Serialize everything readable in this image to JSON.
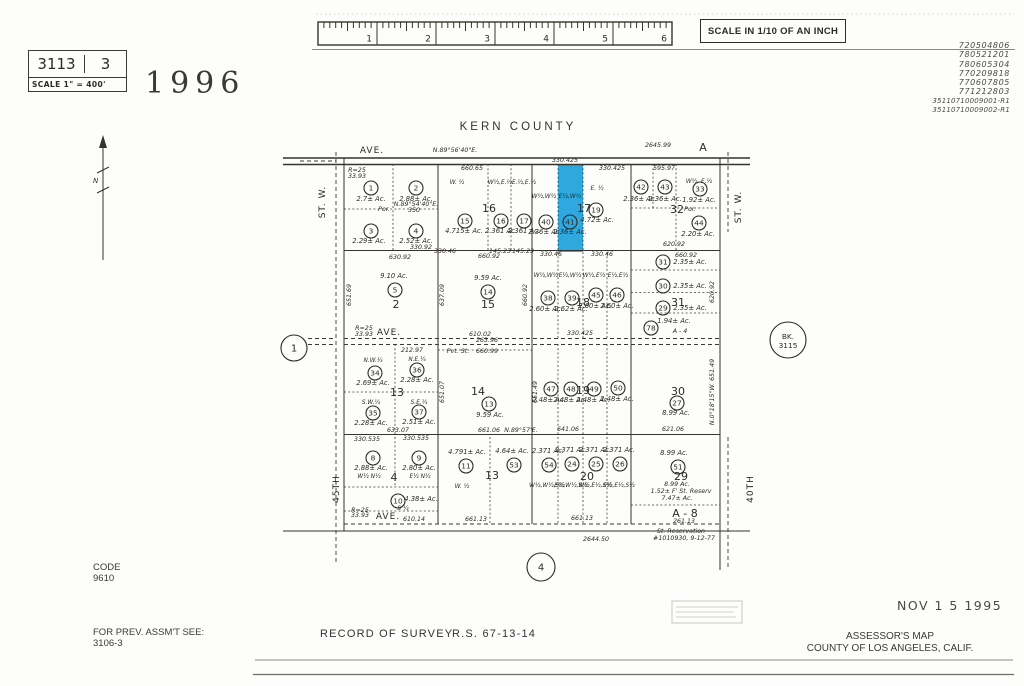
{
  "header": {
    "book": "3113",
    "page": "3",
    "scale_note": "SCALE 1\" = 400'",
    "year": "1996",
    "ruler_caption": "SCALE IN 1/10 OF AN INCH",
    "ruler_ticks": [
      "1",
      "2",
      "3",
      "4",
      "5",
      "6"
    ],
    "stamp_numbers": [
      "720504806",
      "780521201",
      "780605304",
      "770209818",
      "770607805",
      "771212803",
      "35110710009001-R1",
      "35110710009002-R1"
    ]
  },
  "map": {
    "county_label": "KERN  COUNTY",
    "highlight": {
      "parcel": "41",
      "x": 558,
      "y": 164,
      "w": 25,
      "h": 88,
      "color": "#2fa8df"
    },
    "north_label": "N",
    "ref_circles": [
      {
        "label": "1",
        "x": 294,
        "y": 348,
        "r": 13
      },
      {
        "label": "4",
        "x": 541,
        "y": 567,
        "r": 14
      },
      {
        "label": "BK.",
        "label2": "3115",
        "x": 788,
        "y": 340,
        "r": 18
      }
    ],
    "streets": [
      {
        "t": "ST. W.",
        "x": 325,
        "y": 202,
        "rot": -90
      },
      {
        "t": "ST. W.",
        "x": 741,
        "y": 207,
        "rot": -90
      },
      {
        "t": "45TH",
        "x": 339,
        "y": 489,
        "rot": -90
      },
      {
        "t": "40TH",
        "x": 753,
        "y": 489,
        "rot": -90
      },
      {
        "t": "AVE.",
        "x": 389,
        "y": 335,
        "rot": 0
      },
      {
        "t": "AVE.",
        "x": 388,
        "y": 519,
        "rot": 0
      },
      {
        "t": "AVE.",
        "x": 372,
        "y": 153,
        "rot": 0
      }
    ],
    "sections": [
      {
        "t": "16",
        "x": 489,
        "y": 212
      },
      {
        "t": "17",
        "x": 584,
        "y": 212
      },
      {
        "t": "32",
        "x": 677,
        "y": 213
      },
      {
        "t": "2",
        "x": 396,
        "y": 308
      },
      {
        "t": "15",
        "x": 488,
        "y": 308
      },
      {
        "t": "18",
        "x": 583,
        "y": 306
      },
      {
        "t": "31",
        "x": 678,
        "y": 306
      },
      {
        "t": "13",
        "x": 397,
        "y": 396
      },
      {
        "t": "14",
        "x": 478,
        "y": 395
      },
      {
        "t": "19",
        "x": 583,
        "y": 394
      },
      {
        "t": "30",
        "x": 678,
        "y": 395
      },
      {
        "t": "4",
        "x": 394,
        "y": 481
      },
      {
        "t": "13",
        "x": 492,
        "y": 479
      },
      {
        "t": "20",
        "x": 587,
        "y": 480
      },
      {
        "t": "29",
        "x": 681,
        "y": 480
      },
      {
        "t": "A - 8",
        "x": 685,
        "y": 517
      },
      {
        "t": "A",
        "x": 703,
        "y": 151
      }
    ],
    "parcels": [
      {
        "num": "1",
        "cx": 371,
        "cy": 188,
        "ac": "2.7± Ac.",
        "ax": 371,
        "ay": 201
      },
      {
        "num": "2",
        "cx": 416,
        "cy": 188,
        "ac": "2.88± Ac.",
        "ax": 416,
        "ay": 201
      },
      {
        "num": "3",
        "cx": 371,
        "cy": 231,
        "ac": "2.29± Ac.",
        "ax": 369,
        "ay": 243
      },
      {
        "num": "4",
        "cx": 416,
        "cy": 231,
        "ac": "2.52± Ac.",
        "ax": 416,
        "ay": 243
      },
      {
        "num": "15",
        "cx": 465,
        "cy": 221,
        "ac": "4.715± Ac.",
        "ax": 464,
        "ay": 233
      },
      {
        "num": "16",
        "cx": 501,
        "cy": 221,
        "ac": "2.361 Ac.",
        "ax": 501,
        "ay": 233
      },
      {
        "num": "17",
        "cx": 524,
        "cy": 221,
        "ac": "2.361 Ac.",
        "ax": 524,
        "ay": 233
      },
      {
        "num": "40",
        "cx": 546,
        "cy": 222,
        "ac": "2.36± Ac.",
        "ax": 545,
        "ay": 234
      },
      {
        "num": "41",
        "cx": 570,
        "cy": 222,
        "ac": "2.36± Ac.",
        "ax": 570,
        "ay": 234
      },
      {
        "num": "19",
        "cx": 596,
        "cy": 210,
        "ac": "4.72± Ac.",
        "ax": 597,
        "ay": 222
      },
      {
        "num": "42",
        "cx": 641,
        "cy": 187,
        "ac": "2.36± Ac.",
        "ax": 640,
        "ay": 201
      },
      {
        "num": "43",
        "cx": 665,
        "cy": 187,
        "ac": "2.36± Ac.",
        "ax": 665,
        "ay": 201
      },
      {
        "num": "33",
        "cx": 700,
        "cy": 189,
        "ac": "1.92± Ac.",
        "ax": 699,
        "ay": 202
      },
      {
        "num": "44",
        "cx": 699,
        "cy": 223,
        "ac": "2.20± Ac.",
        "ax": 698,
        "ay": 236
      },
      {
        "num": "5",
        "cx": 395,
        "cy": 290,
        "ac": "9.10 Ac.",
        "ax": 394,
        "ay": 278
      },
      {
        "num": "14",
        "cx": 488,
        "cy": 292,
        "ac": "9.59 Ac.",
        "ax": 488,
        "ay": 280
      },
      {
        "num": "38",
        "cx": 548,
        "cy": 298,
        "ac": "2.60± Ac.",
        "ax": 546,
        "ay": 311
      },
      {
        "num": "39",
        "cx": 572,
        "cy": 298,
        "ac": "2.62± Ac.",
        "ax": 571,
        "ay": 311
      },
      {
        "num": "45",
        "cx": 596,
        "cy": 295,
        "ac": "2.60± Ac.",
        "ax": 595,
        "ay": 308
      },
      {
        "num": "46",
        "cx": 617,
        "cy": 295,
        "ac": "2.60± Ac.",
        "ax": 617,
        "ay": 308
      },
      {
        "num": "31",
        "cx": 663,
        "cy": 262,
        "ac": "2.35± Ac.",
        "ax": 690,
        "ay": 264
      },
      {
        "num": "30",
        "cx": 663,
        "cy": 286,
        "ac": "2.35± Ac.",
        "ax": 690,
        "ay": 288
      },
      {
        "num": "29",
        "cx": 663,
        "cy": 308,
        "ac": "2.35± Ac.",
        "ax": 690,
        "ay": 310
      },
      {
        "num": "78",
        "cx": 651,
        "cy": 328,
        "ac": "1.94± Ac.",
        "ax": 674,
        "ay": 323
      },
      {
        "num": "34",
        "cx": 375,
        "cy": 373,
        "ac": "2.69± Ac.",
        "ax": 373,
        "ay": 385
      },
      {
        "num": "36",
        "cx": 417,
        "cy": 370,
        "ac": "2.28± Ac.",
        "ax": 417,
        "ay": 382
      },
      {
        "num": "35",
        "cx": 373,
        "cy": 413,
        "ac": "2.28± Ac.",
        "ax": 371,
        "ay": 425
      },
      {
        "num": "37",
        "cx": 419,
        "cy": 412,
        "ac": "2.51± Ac.",
        "ax": 419,
        "ay": 424
      },
      {
        "num": "13",
        "cx": 489,
        "cy": 404,
        "ac": "9.59 Ac.",
        "ax": 490,
        "ay": 417
      },
      {
        "num": "47",
        "cx": 551,
        "cy": 389,
        "ac": "2.48± Ac.",
        "ax": 549,
        "ay": 402
      },
      {
        "num": "48",
        "cx": 571,
        "cy": 389,
        "ac": "2.48± Ac.",
        "ax": 570,
        "ay": 402
      },
      {
        "num": "49",
        "cx": 594,
        "cy": 389,
        "ac": "2.48± Ac.",
        "ax": 593,
        "ay": 402
      },
      {
        "num": "50",
        "cx": 618,
        "cy": 388,
        "ac": "2.48± Ac.",
        "ax": 617,
        "ay": 401
      },
      {
        "num": "27",
        "cx": 677,
        "cy": 403,
        "ac": "8.99 Ac.",
        "ax": 676,
        "ay": 415
      },
      {
        "num": "8",
        "cx": 373,
        "cy": 458,
        "ac": "2.88± Ac.",
        "ax": 371,
        "ay": 470
      },
      {
        "num": "9",
        "cx": 419,
        "cy": 458,
        "ac": "2.80± Ac.",
        "ax": 419,
        "ay": 470
      },
      {
        "num": "10",
        "cx": 398,
        "cy": 501,
        "ac": "4.38± Ac.",
        "ax": 421,
        "ay": 501
      },
      {
        "num": "11",
        "cx": 466,
        "cy": 466,
        "ac": "4.791± Ac.",
        "ax": 467,
        "ay": 454
      },
      {
        "num": "53",
        "cx": 514,
        "cy": 465,
        "ac": "4.64± Ac.",
        "ax": 512,
        "ay": 453
      },
      {
        "num": "54",
        "cx": 549,
        "cy": 465,
        "ac": "2.371 Ac.",
        "ax": 548,
        "ay": 453
      },
      {
        "num": "24",
        "cx": 572,
        "cy": 464,
        "ac": "2.371 Ac.",
        "ax": 571,
        "ay": 452
      },
      {
        "num": "25",
        "cx": 596,
        "cy": 464,
        "ac": "2.371 Ac.",
        "ax": 595,
        "ay": 452
      },
      {
        "num": "26",
        "cx": 620,
        "cy": 464,
        "ac": "2.371 Ac.",
        "ax": 619,
        "ay": 452
      },
      {
        "num": "51",
        "cx": 678,
        "cy": 467,
        "ac": "8.99 Ac.",
        "ax": 674,
        "ay": 455
      }
    ],
    "texts": [
      {
        "t": "N.89°56'40\"E.",
        "x": 455,
        "y": 152,
        "cls": "dim"
      },
      {
        "t": "2645.99",
        "x": 658,
        "y": 147,
        "cls": "dim"
      },
      {
        "t": "660.65",
        "x": 472,
        "y": 170,
        "cls": "dim"
      },
      {
        "t": "330.425",
        "x": 565,
        "y": 162,
        "cls": "dim"
      },
      {
        "t": "330.425",
        "x": 612,
        "y": 170,
        "cls": "dim"
      },
      {
        "t": "595.97",
        "x": 664,
        "y": 170,
        "cls": "dim"
      },
      {
        "t": "R=25",
        "x": 357,
        "y": 172,
        "cls": "dim"
      },
      {
        "t": "33.93",
        "x": 357,
        "y": 178,
        "cls": "dim"
      },
      {
        "t": "W. ½",
        "x": 457,
        "y": 184,
        "cls": "frac"
      },
      {
        "t": "W½,E.½",
        "x": 500,
        "y": 184,
        "cls": "frac"
      },
      {
        "t": "E.½,E.½",
        "x": 524,
        "y": 184,
        "cls": "frac"
      },
      {
        "t": "W½,W½",
        "x": 544,
        "y": 198,
        "cls": "frac"
      },
      {
        "t": "E½,W½",
        "x": 570,
        "y": 198,
        "cls": "frac"
      },
      {
        "t": "E. ½",
        "x": 597,
        "y": 190,
        "cls": "frac"
      },
      {
        "t": "W½, E.½",
        "x": 699,
        "y": 183,
        "cls": "frac"
      },
      {
        "t": "N.89°54'40\"E.",
        "x": 416,
        "y": 206,
        "cls": "dim"
      },
      {
        "t": "350",
        "x": 414,
        "y": 212,
        "cls": "dim"
      },
      {
        "t": "Por.",
        "x": 384,
        "y": 211,
        "cls": "note"
      },
      {
        "t": "Por.",
        "x": 690,
        "y": 211,
        "cls": "note"
      },
      {
        "t": "330.92",
        "x": 421,
        "y": 249,
        "cls": "dim"
      },
      {
        "t": "330.46",
        "x": 445,
        "y": 253,
        "cls": "dim"
      },
      {
        "t": "145.23",
        "x": 500,
        "y": 253,
        "cls": "dim"
      },
      {
        "t": "145.23",
        "x": 523,
        "y": 253,
        "cls": "dim"
      },
      {
        "t": "620.92",
        "x": 674,
        "y": 246,
        "cls": "dim"
      },
      {
        "t": "630.92",
        "x": 400,
        "y": 259,
        "cls": "dim"
      },
      {
        "t": "660.92",
        "x": 489,
        "y": 258,
        "cls": "dim"
      },
      {
        "t": "330.46",
        "x": 551,
        "y": 256,
        "cls": "dim"
      },
      {
        "t": "330.46",
        "x": 602,
        "y": 256,
        "cls": "dim"
      },
      {
        "t": "660.92",
        "x": 686,
        "y": 257,
        "cls": "dim"
      },
      {
        "t": "W½,W½",
        "x": 546,
        "y": 277,
        "cls": "frac"
      },
      {
        "t": "E½,W½",
        "x": 570,
        "y": 277,
        "cls": "frac"
      },
      {
        "t": "W½,E½",
        "x": 594,
        "y": 277,
        "cls": "frac"
      },
      {
        "t": "E½,E½",
        "x": 618,
        "y": 277,
        "cls": "frac"
      },
      {
        "t": "651.69",
        "x": 351,
        "y": 295,
        "cls": "dim",
        "rot": -90
      },
      {
        "t": "637.09",
        "x": 444,
        "y": 295,
        "cls": "dim",
        "rot": -90
      },
      {
        "t": "660.92",
        "x": 527,
        "y": 295,
        "cls": "dim",
        "rot": -90
      },
      {
        "t": "620.92",
        "x": 714,
        "y": 292,
        "cls": "dim",
        "rot": -90
      },
      {
        "t": "A - 4",
        "x": 680,
        "y": 333,
        "cls": "note"
      },
      {
        "t": "1.94± Ac.",
        "x": 676,
        "y": 324,
        "cls": "hid"
      },
      {
        "t": "610.02",
        "x": 480,
        "y": 336,
        "cls": "dim"
      },
      {
        "t": "263.96",
        "x": 487,
        "y": 342,
        "cls": "dim"
      },
      {
        "t": "330.425",
        "x": 580,
        "y": 335,
        "cls": "dim"
      },
      {
        "t": "R=25",
        "x": 364,
        "y": 330,
        "cls": "dim"
      },
      {
        "t": "33.93",
        "x": 364,
        "y": 336,
        "cls": "dim"
      },
      {
        "t": "212.97",
        "x": 412,
        "y": 352,
        "cls": "dim"
      },
      {
        "t": "633.97",
        "x": 412,
        "y": 358,
        "cls": "hid"
      },
      {
        "t": "N.W.¼",
        "x": 373,
        "y": 362,
        "cls": "frac"
      },
      {
        "t": "N.E.¼",
        "x": 417,
        "y": 361,
        "cls": "frac"
      },
      {
        "t": "S.W.¼",
        "x": 371,
        "y": 404,
        "cls": "frac"
      },
      {
        "t": "S.E.¼",
        "x": 419,
        "y": 404,
        "cls": "frac"
      },
      {
        "t": "Pvt. St.",
        "x": 458,
        "y": 353,
        "cls": "note"
      },
      {
        "t": "660.99",
        "x": 487,
        "y": 353,
        "cls": "dim"
      },
      {
        "t": "651.07",
        "x": 444,
        "y": 392,
        "cls": "dim",
        "rot": -90
      },
      {
        "t": "651.49",
        "x": 537,
        "y": 392,
        "cls": "dim",
        "rot": -90
      },
      {
        "t": "N.0°18'15\"W. 651.49",
        "x": 714,
        "y": 392,
        "cls": "dim",
        "rot": -90
      },
      {
        "t": "633.07",
        "x": 398,
        "y": 432,
        "cls": "dim"
      },
      {
        "t": "661.06",
        "x": 489,
        "y": 432,
        "cls": "dim"
      },
      {
        "t": "N.89°57'E.",
        "x": 521,
        "y": 432,
        "cls": "dim"
      },
      {
        "t": "641.06",
        "x": 568,
        "y": 431,
        "cls": "dim"
      },
      {
        "t": "621.06",
        "x": 673,
        "y": 431,
        "cls": "dim"
      },
      {
        "t": "330.535",
        "x": 367,
        "y": 441,
        "cls": "dim"
      },
      {
        "t": "330.535",
        "x": 416,
        "y": 440,
        "cls": "dim"
      },
      {
        "t": "W½ N½",
        "x": 369,
        "y": 478,
        "cls": "frac"
      },
      {
        "t": "E½ N½",
        "x": 420,
        "y": 478,
        "cls": "frac"
      },
      {
        "t": "S ½",
        "x": 403,
        "y": 510,
        "cls": "frac"
      },
      {
        "t": "W. ½",
        "x": 462,
        "y": 488,
        "cls": "frac"
      },
      {
        "t": "W½,W½,S½",
        "x": 547,
        "y": 487,
        "cls": "frac"
      },
      {
        "t": "E½,W½,S½",
        "x": 571,
        "y": 487,
        "cls": "frac"
      },
      {
        "t": "W½,E½,S½",
        "x": 595,
        "y": 487,
        "cls": "frac"
      },
      {
        "t": "E½,E½,S½",
        "x": 619,
        "y": 487,
        "cls": "frac"
      },
      {
        "t": "8.99 Ac.",
        "x": 677,
        "y": 486,
        "cls": "note"
      },
      {
        "t": "1.52± F' St. Reserv",
        "x": 681,
        "y": 493,
        "cls": "note"
      },
      {
        "t": "7.47± Ac.",
        "x": 677,
        "y": 500,
        "cls": "note"
      },
      {
        "t": "R=25",
        "x": 360,
        "y": 512,
        "cls": "dim"
      },
      {
        "t": "33.93",
        "x": 360,
        "y": 517,
        "cls": "dim"
      },
      {
        "t": "610.14",
        "x": 414,
        "y": 521,
        "cls": "dim"
      },
      {
        "t": "661.13",
        "x": 476,
        "y": 521,
        "cls": "dim"
      },
      {
        "t": "661.13",
        "x": 582,
        "y": 520,
        "cls": "dim"
      },
      {
        "t": "261.13",
        "x": 684,
        "y": 523,
        "cls": "dim"
      },
      {
        "t": "2644.50",
        "x": 596,
        "y": 541,
        "cls": "dim"
      },
      {
        "t": "St. Reservation",
        "x": 681,
        "y": 533,
        "cls": "note"
      },
      {
        "t": "#1010930, 9-12-77",
        "x": 684,
        "y": 540,
        "cls": "note"
      }
    ]
  },
  "footer": {
    "code_label": "CODE",
    "code_value": "9610",
    "prev_label": "FOR PREV. ASSM'T SEE:",
    "prev_value": "3106-3",
    "record_of_survey": "RECORD OF SURVEY",
    "rs_number": "R.S. 67-13-14",
    "date_stamp": "NOV 1 5 1995",
    "assessor_line1": "ASSESSOR'S MAP",
    "assessor_line2": "COUNTY OF LOS ANGELES, CALIF."
  }
}
